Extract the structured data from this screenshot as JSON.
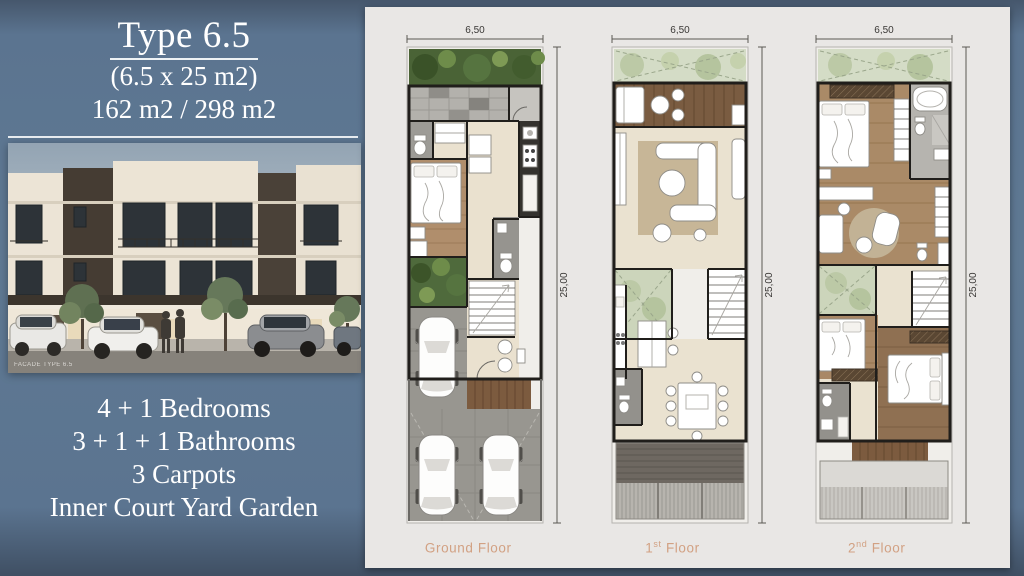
{
  "slide": {
    "background_color": "#5c7590",
    "panel_color": "#e9e7e5",
    "accent_label_color": "#d2a183"
  },
  "info": {
    "title": "Type 6.5",
    "size_label": "(6.5 x 25 m2)",
    "area_label": "162 m2 / 298 m2",
    "facade_caption": "FACADE TYPE 6.5",
    "features": [
      "4 + 1 Bedrooms",
      "3 + 1 + 1 Bathrooms",
      "3 Carpots",
      "Inner Court Yard Garden"
    ]
  },
  "plans": {
    "floors": [
      {
        "label_pre": "Ground",
        "label_sup": "",
        "label_post": " Floor",
        "width_label": "6,50",
        "height_label": "25,00"
      },
      {
        "label_pre": "1",
        "label_sup": "st",
        "label_post": " Floor",
        "width_label": "6,50",
        "height_label": "25,00"
      },
      {
        "label_pre": "2",
        "label_sup": "nd",
        "label_post": " Floor",
        "width_label": "6,50",
        "height_label": "25,00"
      }
    ]
  }
}
